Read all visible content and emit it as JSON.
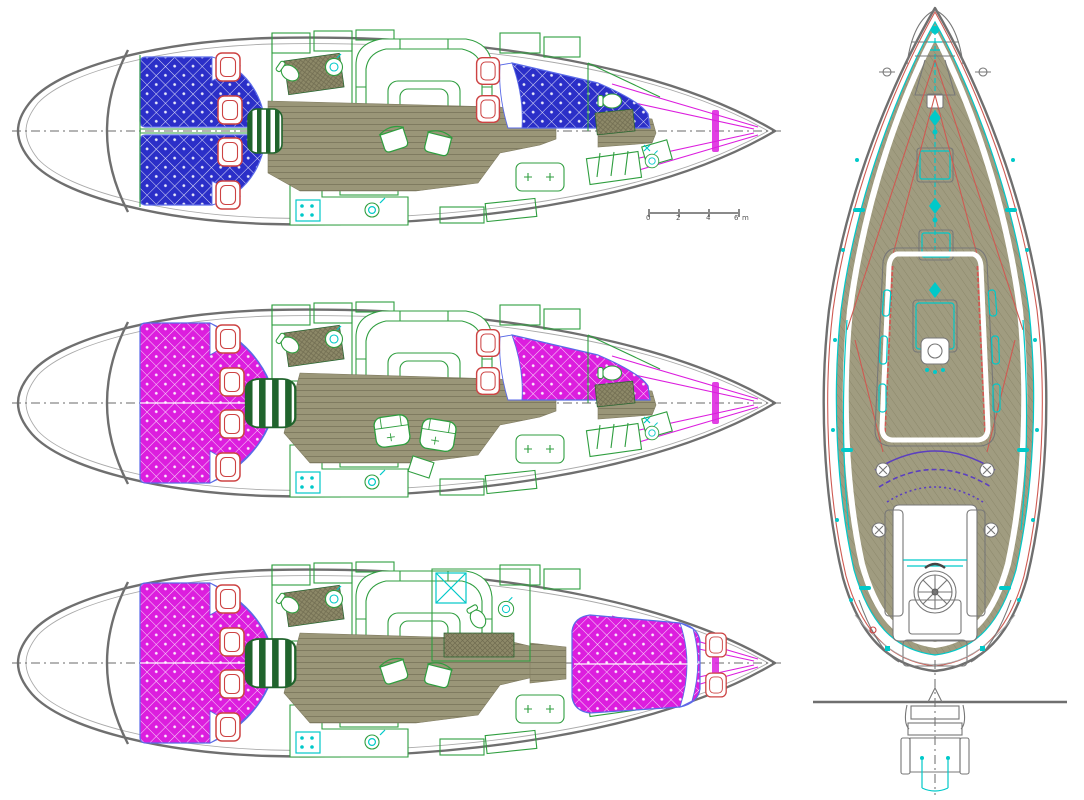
{
  "document": {
    "type": "sailing-yacht-plan-sheet",
    "views": 4
  },
  "colors": {
    "hull_outline": "#6f6f6f",
    "inner_line": "#aaaaaa",
    "furniture_green": "#2f9e3f",
    "dark_green": "#20642c",
    "floor_olive": "#9a9678",
    "floor_plank": "#7f7b60",
    "berth_blue": "#2b2fc8",
    "berth_blue_edge": "#5a6ae8",
    "berth_magenta": "#dc1ede",
    "pillow_red": "#cd4343",
    "fixture_cyan": "#00c9c9",
    "deck_khaki": "#a09c80",
    "deck_hatchline": "#8a8668",
    "rig_red": "#cf5a52",
    "sprayhood_purple": "#5b3fc0",
    "centerline_gray": "#6a6a6a",
    "roof_grid": "#a9a694"
  },
  "scale_bar": {
    "ticks": [
      "0",
      "2",
      "4",
      "6"
    ],
    "unit": "m"
  },
  "plans": [
    {
      "name": "interior-layout-top",
      "berth_color": "blue",
      "aft_cabins": 2,
      "fore_berth": "v-berth"
    },
    {
      "name": "interior-layout-middle",
      "berth_color": "magenta",
      "aft_cabins": 1,
      "fore_berth": "v-berth"
    },
    {
      "name": "interior-layout-bottom",
      "berth_color": "magenta",
      "aft_cabins": 1,
      "fore_berth": "island-berth"
    }
  ],
  "deck_plan": {
    "name": "deck-plan",
    "orientation": "bow-up",
    "transom": "fold-down-with-ladder"
  }
}
